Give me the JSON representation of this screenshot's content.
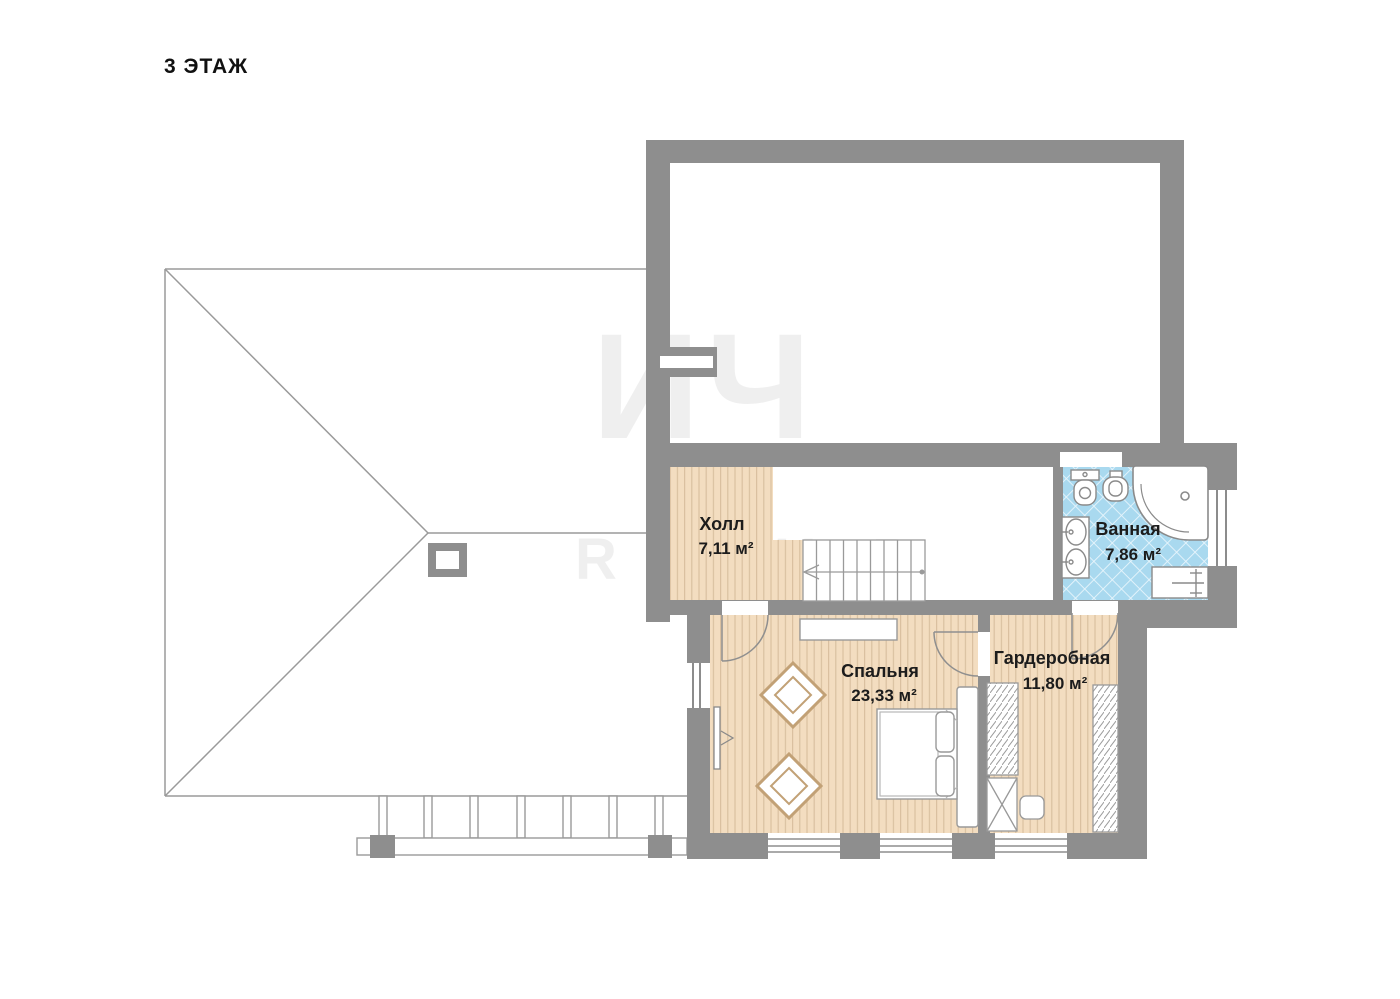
{
  "page": {
    "title": "3 ЭТАЖ"
  },
  "watermark": {
    "line1": "ИЧ",
    "line2": "R O U P"
  },
  "rooms": {
    "hall": {
      "name": "Холл",
      "area": "7,11 м²"
    },
    "bathroom": {
      "name": "Ванная",
      "area": "7,86 м²"
    },
    "bedroom": {
      "name": "Спальня",
      "area": "23,33 м²"
    },
    "wardrobe": {
      "name": "Гардеробная",
      "area": "11,80 м²"
    }
  },
  "colors": {
    "wall": "#8e8e8e",
    "wood_floor": "#f3ddc0",
    "wood_stripe": "#d9c0a0",
    "tile_floor": "#a9d9ef",
    "tile_line": "#e8f5fc",
    "outline": "#9a9a9a",
    "label_text": "#1c1c1c"
  }
}
